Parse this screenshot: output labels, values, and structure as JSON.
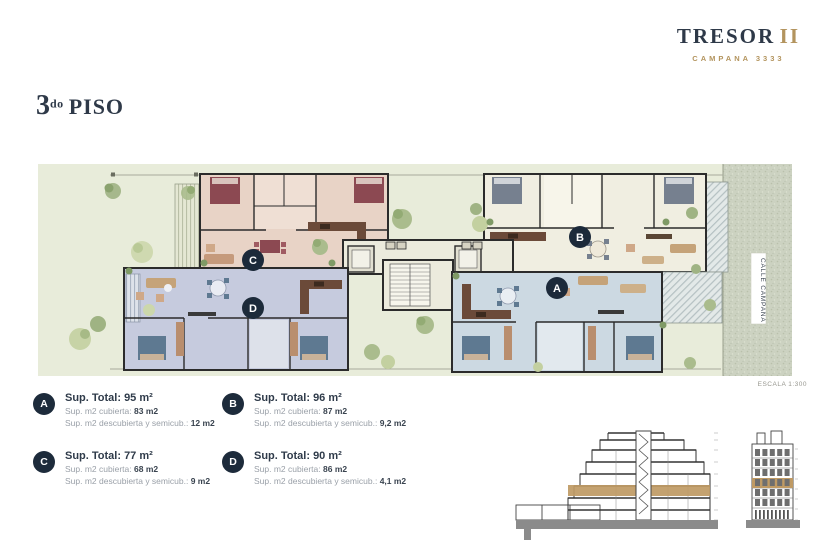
{
  "header": {
    "brand": "TRESOR",
    "brand_suffix": "II",
    "subtitle": "CAMPANA 3333"
  },
  "page": {
    "floor_number": "3",
    "floor_ordinal": "do",
    "floor_word": "PISO"
  },
  "plan": {
    "street_label": "CALLE CAMPANA",
    "scale_label": "ESCALA 1:300",
    "unit_labels": {
      "a": "A",
      "b": "B",
      "c": "C",
      "d": "D"
    }
  },
  "legend": {
    "items": [
      {
        "id": "A",
        "total": "Sup. Total: 95 m²",
        "covered_label": "Sup. m2 cubierta:",
        "covered_value": "83 m2",
        "uncovered_label": "Sup. m2 descubierta y semicub.:",
        "uncovered_value": "12 m2"
      },
      {
        "id": "B",
        "total": "Sup. Total: 96 m²",
        "covered_label": "Sup. m2 cubierta:",
        "covered_value": "87 m2",
        "uncovered_label": "Sup. m2 descubierta y semicub.:",
        "uncovered_value": "9,2 m2"
      },
      {
        "id": "C",
        "total": "Sup. Total: 77 m²",
        "covered_label": "Sup. m2 cubierta:",
        "covered_value": "68 m2",
        "uncovered_label": "Sup. m2 descubierta y semicub.:",
        "uncovered_value": "9 m2"
      },
      {
        "id": "D",
        "total": "Sup. Total: 90 m²",
        "covered_label": "Sup. m2 cubierta:",
        "covered_value": "86 m2",
        "uncovered_label": "Sup. m2 descubierta y semicub.:",
        "uncovered_value": "4,1 m2"
      }
    ]
  },
  "colors": {
    "navy": "#2e3948",
    "gold": "#b3945e",
    "unit_a": "#ccd9e2",
    "unit_b": "#f0eee1",
    "unit_c": "#e8d3c6",
    "unit_d": "#c6cbde",
    "grass": "#e8ecda",
    "street": "#ccd2c1",
    "highlight_floor": "#bf9a64"
  }
}
